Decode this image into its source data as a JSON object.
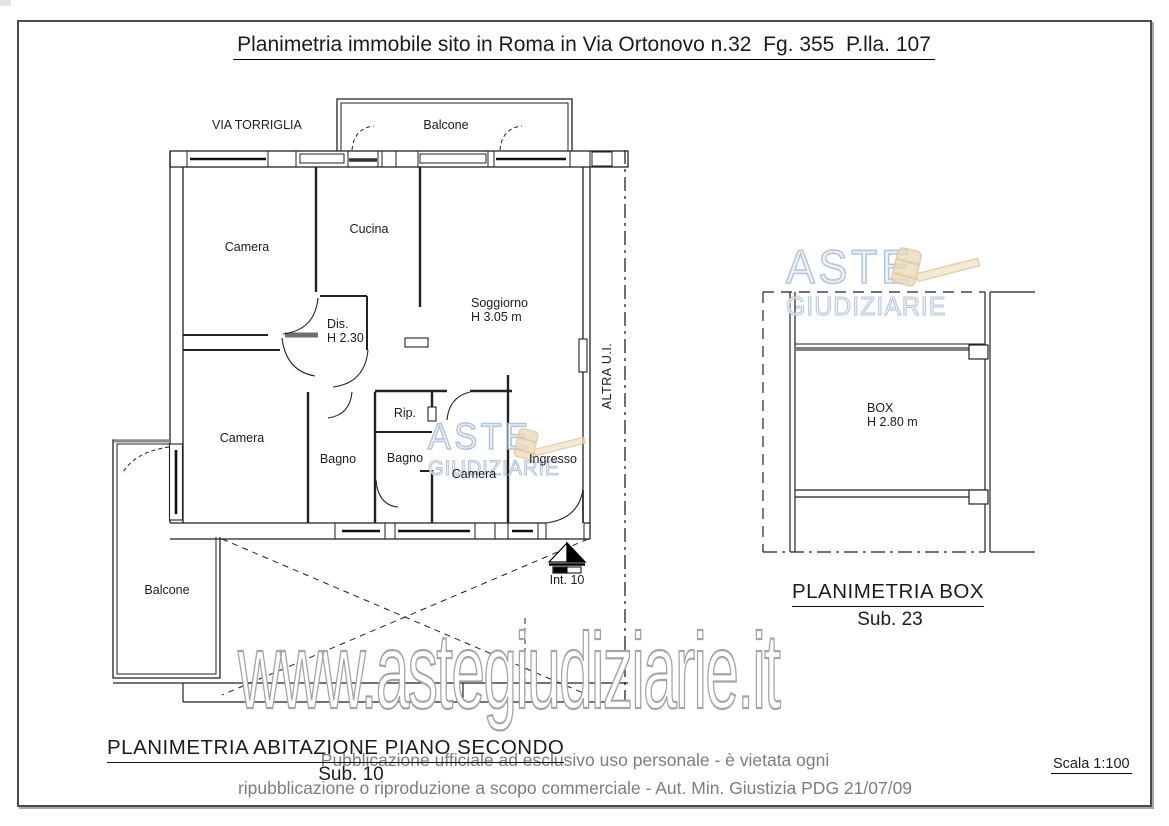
{
  "page": {
    "title": "Planimetria immobile sito in Roma in Via Ortonovo n.32  Fg. 355  P.lla. 107",
    "scale": "Scala 1:100",
    "watermark_url": "www.astegiudiziarie.it",
    "disclaimer": {
      "line1": "Pubblicazione ufficiale ad esclusivo uso personale - è vietata ogni",
      "line2": "ripubblicazione o riproduzione a scopo commerciale - Aut. Min. Giustizia PDG 21/07/09"
    }
  },
  "brand": {
    "name_top": "ASTE",
    "name_bottom": "GIUDIZIARIE",
    "accent_blue": "#b3c4d8",
    "gavel_tan": "#e9d6b4"
  },
  "apartment_plan": {
    "caption": "PLANIMETRIA ABITAZIONE PIANO SECONDO",
    "sub": "Sub. 10",
    "street": "VIA TORRIGLIA",
    "labels": {
      "balcony_top": "Balcone",
      "balcony_left": "Balcone",
      "camera_top": "Camera",
      "cucina": "Cucina",
      "soggiorno": "Soggiorno",
      "soggiorno_h": "H 3.05 m",
      "dis": "Dis.",
      "dis_h": "H 2.30",
      "camera_mid": "Camera",
      "bagno_1": "Bagno",
      "bagno_2": "Bagno",
      "rip": "Rip.",
      "camera_small": "Camera",
      "ingresso": "Ingresso",
      "altra_ui": "ALTRA U.I.",
      "interno": "Int. 10"
    }
  },
  "box_plan": {
    "caption": "PLANIMETRIA BOX",
    "sub": "Sub. 23",
    "label": "BOX",
    "height": "H 2.80 m"
  }
}
